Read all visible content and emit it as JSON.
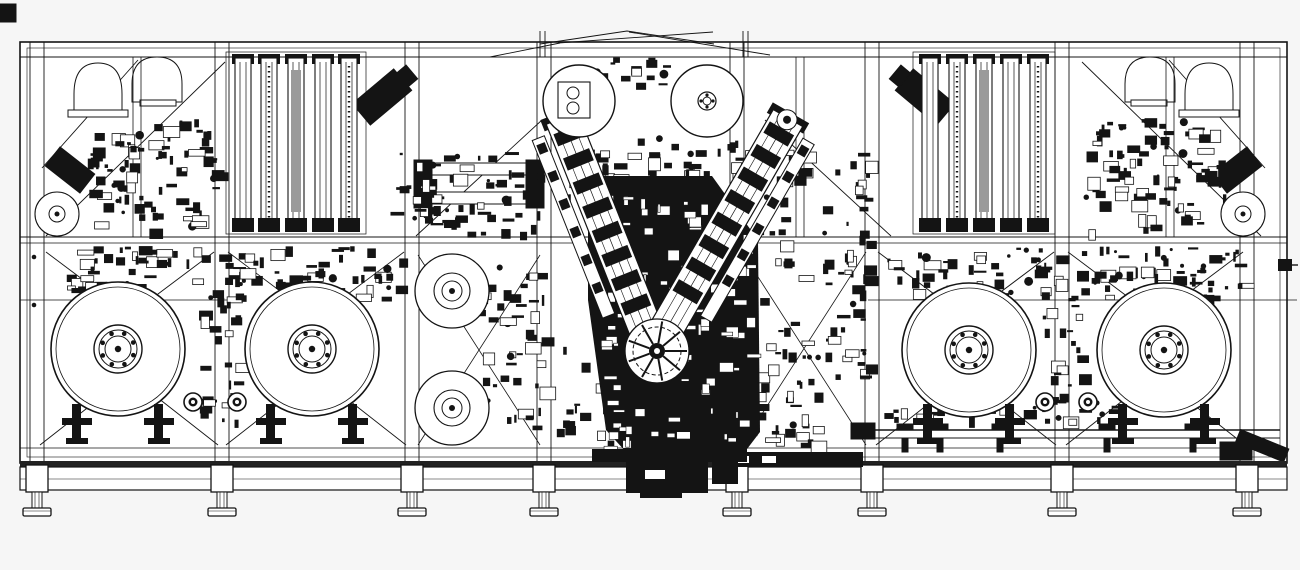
{
  "drawing": {
    "kind": "cad-machine-assembly-side-view",
    "canvas": {
      "width": 1300,
      "height": 570
    },
    "colors": {
      "ink": "#141414",
      "paper": "#ffffff",
      "background": "#f6f6f6",
      "gray_fill": "#9a9a9a"
    },
    "components": [
      "machine-frame",
      "leveling-feet",
      "unwind-reels",
      "buffer-columns",
      "dome-hoppers",
      "v-feed-arms",
      "process-turret",
      "guide-rolls",
      "discharge-rail",
      "mid-guide-rolls",
      "side-tape-rolls"
    ],
    "machine": {
      "frame": {
        "x": 20,
        "y": 42,
        "w": 1267,
        "h": 421,
        "inner_top_y": 57,
        "mid_rail_y1": 237,
        "mid_rail_y2": 243,
        "lower_line_y": 448,
        "full_posts_x": [
          37,
          222,
          412,
          544,
          737,
          872,
          1062,
          1247
        ],
        "upper_posts_x": [
          137,
          800,
          1170
        ]
      },
      "feet_x": [
        37,
        222,
        412,
        544,
        737,
        872,
        1062,
        1247
      ],
      "reels": [
        {
          "cx": 118,
          "cy": 349,
          "r": 67
        },
        {
          "cx": 312,
          "cy": 349,
          "r": 67
        },
        {
          "cx": 969,
          "cy": 350,
          "r": 67
        },
        {
          "cx": 1164,
          "cy": 350,
          "r": 67
        }
      ],
      "reel_pair_rollers": [
        {
          "cx": 193,
          "cy": 402,
          "r": 9
        },
        {
          "cx": 237,
          "cy": 402,
          "r": 9
        },
        {
          "cx": 1045,
          "cy": 402,
          "r": 9
        },
        {
          "cx": 1088,
          "cy": 402,
          "r": 9
        }
      ],
      "top_rolls": [
        {
          "cx": 579,
          "cy": 101,
          "r": 36,
          "style": "boxed"
        },
        {
          "cx": 707,
          "cy": 101,
          "r": 36,
          "style": "hub"
        }
      ],
      "mid_rolls": [
        {
          "cx": 452,
          "cy": 291,
          "r": 37
        },
        {
          "cx": 452,
          "cy": 408,
          "r": 37
        }
      ],
      "side_rolls": [
        {
          "cx": 57,
          "cy": 214,
          "r": 22
        },
        {
          "cx": 1243,
          "cy": 214,
          "r": 22
        }
      ],
      "column_banks": [
        {
          "xs": [
            243,
            269,
            296,
            323,
            349
          ],
          "top": 58,
          "h": 168
        },
        {
          "xs": [
            930,
            957,
            984,
            1011,
            1038
          ],
          "top": 58,
          "h": 168
        }
      ],
      "v_arms": [
        {
          "x1": 562,
          "y1": 118,
          "x2": 650,
          "y2": 340,
          "w": 34,
          "side": 1
        },
        {
          "x1": 788,
          "y1": 118,
          "x2": 660,
          "y2": 340,
          "w": 34,
          "side": -1
        }
      ],
      "turret": {
        "cx": 657,
        "cy": 351,
        "r": 32
      },
      "discharge_rail": {
        "x1": 855,
        "x2": 1280,
        "y1": 430,
        "y2": 438,
        "supports_x": [
          905,
          940,
          1000,
          1107,
          1193
        ]
      },
      "dense_zones": [
        [
          78,
          118,
          140,
          112,
          85,
          "dark"
        ],
        [
          55,
          246,
          345,
          52,
          105,
          "dark"
        ],
        [
          196,
          292,
          40,
          128,
          26,
          "dark"
        ],
        [
          416,
          152,
          126,
          80,
          50,
          "dark"
        ],
        [
          476,
          262,
          68,
          172,
          45,
          "dark"
        ],
        [
          566,
          138,
          196,
          66,
          60,
          "dark"
        ],
        [
          760,
          150,
          108,
          142,
          55,
          "dark"
        ],
        [
          757,
          298,
          110,
          88,
          36,
          "dark"
        ],
        [
          1083,
          118,
          140,
          112,
          85,
          "dark"
        ],
        [
          880,
          246,
          362,
          52,
          105,
          "dark"
        ],
        [
          1042,
          292,
          40,
          128,
          26,
          "dark"
        ],
        [
          874,
          402,
          250,
          16,
          20,
          "dark"
        ],
        [
          597,
          56,
          76,
          30,
          16,
          "dark"
        ],
        [
          390,
          152,
          55,
          72,
          18,
          "dark"
        ],
        [
          600,
          195,
          148,
          252,
          115,
          "light"
        ],
        [
          555,
          340,
          60,
          110,
          25,
          "dark"
        ],
        [
          745,
          380,
          80,
          70,
          25,
          "dark"
        ]
      ]
    }
  }
}
